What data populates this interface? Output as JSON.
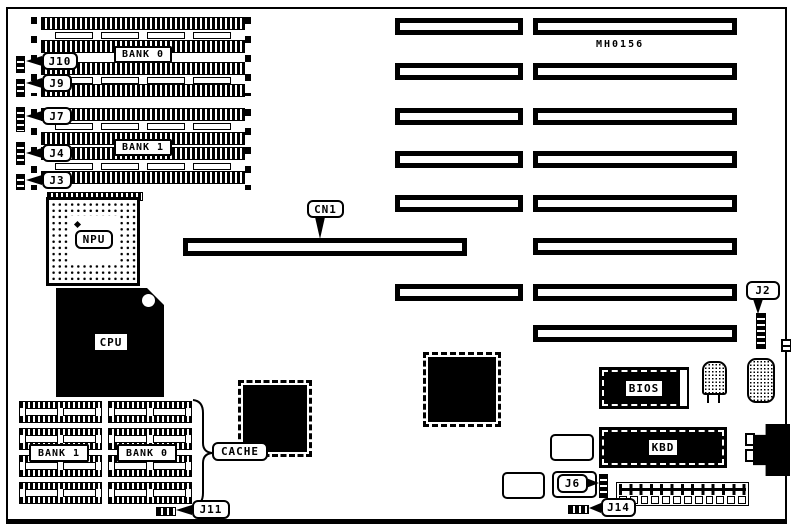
{
  "board": {
    "part_number": "MH0156"
  },
  "simm": {
    "bank0": "BANK 0",
    "bank1": "BANK 1",
    "jumpers": [
      {
        "label": "J10"
      },
      {
        "label": "J9"
      },
      {
        "label": "J7"
      },
      {
        "label": "J4"
      },
      {
        "label": "J3"
      }
    ]
  },
  "processors": {
    "npu": "NPU",
    "cpu": "CPU"
  },
  "connectors": {
    "cn1": "CN1",
    "j2": "J2",
    "j6": "J6",
    "j11": "J11",
    "j14": "J14"
  },
  "cache": {
    "bank1": "BANK 1",
    "bank0": "BANK 0",
    "label": "CACHE"
  },
  "chips": {
    "bios": "BIOS",
    "kbd": "KBD"
  }
}
